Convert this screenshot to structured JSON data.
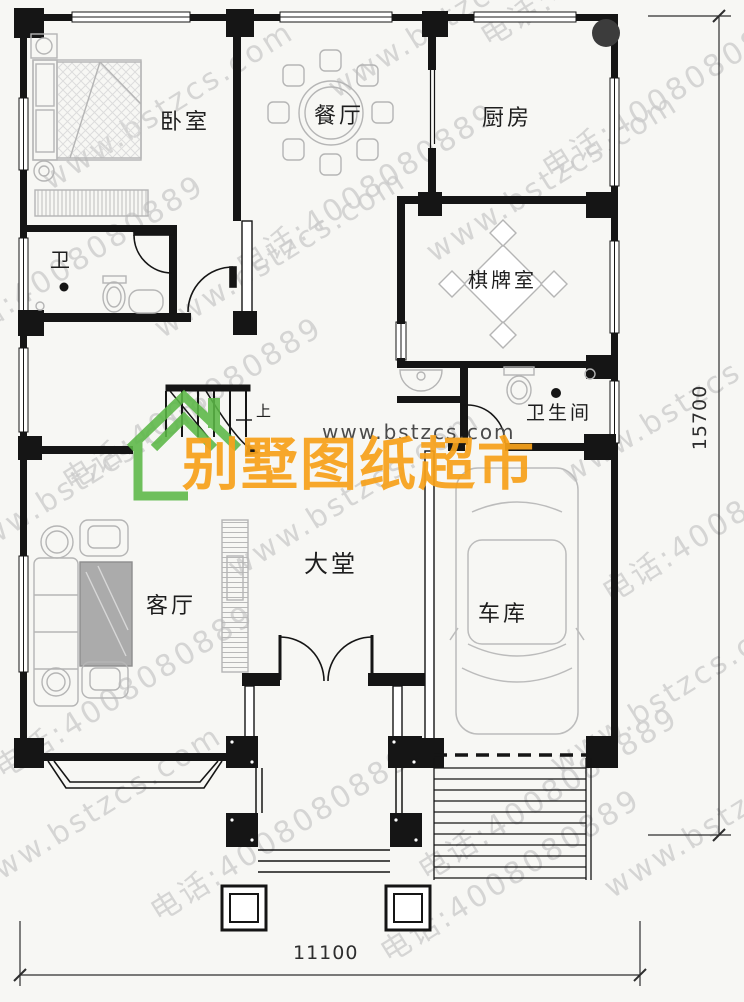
{
  "brand": {
    "site_url": "www.bstzcs.com",
    "name": "别墅图纸超市",
    "orange": "#F7A21B",
    "green": "#5CB847"
  },
  "watermark": {
    "site": "www.bstzcs.com",
    "phone": "电话:4008080889"
  },
  "rooms": {
    "bedroom": "卧室",
    "dining": "餐厅",
    "kitchen": "厨房",
    "bath_small": "卫",
    "chess": "棋牌室",
    "bathroom": "卫生间",
    "living": "客厅",
    "hall": "大堂",
    "garage": "车库",
    "stairs_up": "上"
  },
  "dimensions": {
    "width_mm": "11100",
    "height_mm": "15700"
  }
}
